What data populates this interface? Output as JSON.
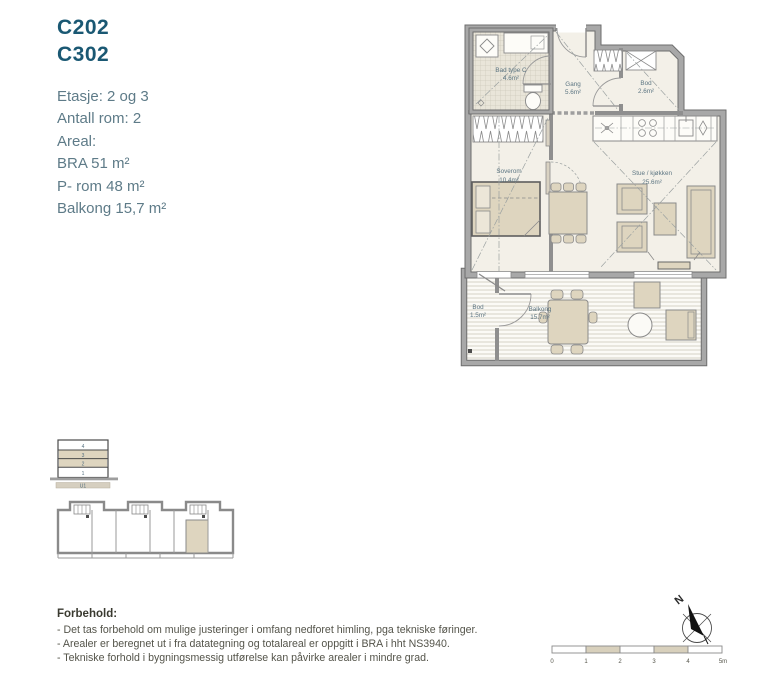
{
  "unit": {
    "codes": [
      "C202",
      "C302"
    ]
  },
  "details": {
    "lines": [
      "Etasje: 2 og 3",
      "Antall rom: 2",
      "Areal:",
      "BRA 51 m²",
      "P- rom 48 m²",
      "Balkong 15,7 m²"
    ]
  },
  "floorplan": {
    "rooms": [
      {
        "name": "Bad type C",
        "area": "4.6m²"
      },
      {
        "name": "Gang",
        "area": "5.6m²"
      },
      {
        "name": "Bod",
        "area": "2.6m²"
      },
      {
        "name": "Soverom",
        "area": "10.4m²"
      },
      {
        "name": "Stue / kjøkken",
        "area": "25.6m²"
      },
      {
        "name": "Balkong",
        "area": "15.7m²"
      },
      {
        "name": "Bod",
        "area": "1.5m²"
      }
    ]
  },
  "section_diagram": {
    "floor_labels": [
      "4",
      "3",
      "2",
      "1"
    ],
    "basement_label": "U1",
    "highlighted_floors": "2 og 3"
  },
  "disclaimer": {
    "heading": "Forbehold:",
    "lines": [
      "- Det tas forbehold om mulige justeringer i omfang nedforet himling, pga tekniske føringer.",
      "- Arealer er beregnet ut i fra datategning og totalareal er oppgitt i BRA i hht NS3940.",
      "- Tekniske forhold i bygningsmessig utførelse kan påvirke arealer i mindre grad."
    ]
  },
  "compass": {
    "north_label": "N"
  },
  "scale_bar": {
    "tick_labels": [
      "0",
      "1",
      "2",
      "3",
      "4",
      "5m"
    ]
  },
  "colors": {
    "accent_teal": "#1a5873",
    "body_text": "#5e7b88",
    "plan_label": "#5c7582",
    "furniture_beige": "#ded5bf",
    "wall_gray": "#a8a8a8",
    "wall_edge": "#6e6e6e",
    "disclaimer_text": "#54544a",
    "scale_beige": "#d8d0bc"
  }
}
